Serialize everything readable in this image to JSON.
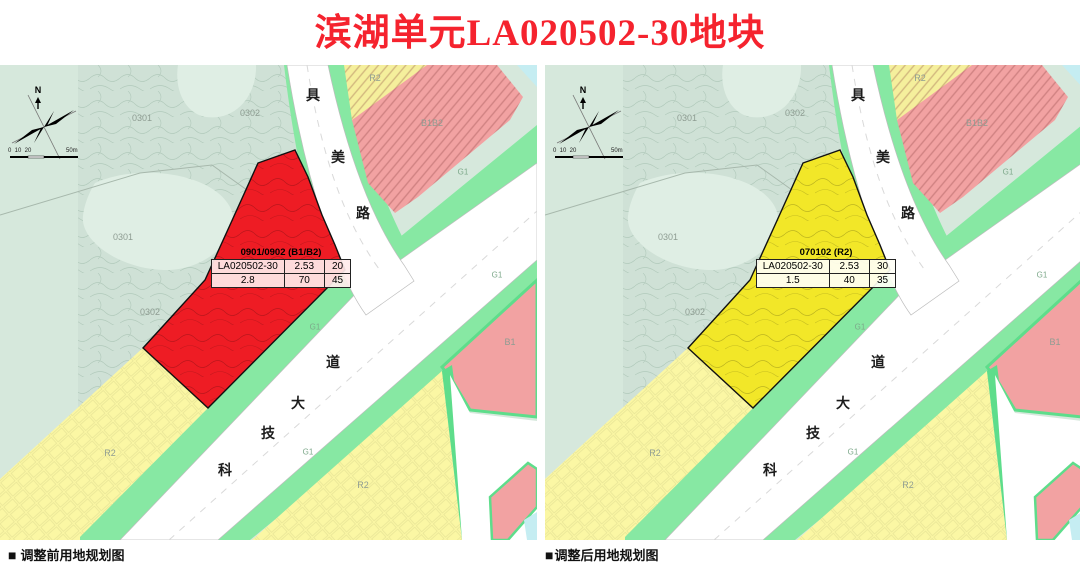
{
  "title": "滨湖单元LA020502-30地块",
  "title_color": "#f5232e",
  "maps": [
    {
      "name": "before",
      "caption_marker": "■",
      "caption": "调整前用地规划图",
      "plot_color": "#ee1c24",
      "plot_table": {
        "header": "0901/0902 (B1/B2)",
        "rows": [
          [
            "LA020502-30",
            "2.53",
            "20"
          ],
          [
            "2.8",
            "70",
            "45"
          ]
        ]
      }
    },
    {
      "name": "after",
      "caption_marker": "■",
      "caption": "调整后用地规划图",
      "plot_color": "#f2e728",
      "plot_table": {
        "header": "070102 (R2)",
        "rows": [
          [
            "LA020502-30",
            "2.53",
            "30"
          ],
          [
            "1.5",
            "40",
            "35"
          ]
        ]
      }
    }
  ],
  "area_labels": [
    {
      "text": "0301",
      "x": 142,
      "y": 53
    },
    {
      "text": "0301",
      "x": 123,
      "y": 172
    },
    {
      "text": "0302",
      "x": 250,
      "y": 48
    },
    {
      "text": "0302",
      "x": 150,
      "y": 247
    },
    {
      "text": "R2",
      "x": 375,
      "y": 13
    },
    {
      "text": "B1B2",
      "x": 432,
      "y": 58
    },
    {
      "text": "G1",
      "x": 463,
      "y": 107,
      "cls": "g1"
    },
    {
      "text": "G1",
      "x": 497,
      "y": 210,
      "cls": "g1"
    },
    {
      "text": "G1",
      "x": 315,
      "y": 262,
      "cls": "g1"
    },
    {
      "text": "G1",
      "x": 308,
      "y": 387,
      "cls": "g1"
    },
    {
      "text": "B1",
      "x": 510,
      "y": 277
    },
    {
      "text": "R2",
      "x": 363,
      "y": 420
    },
    {
      "text": "R2",
      "x": 110,
      "y": 388
    }
  ],
  "road_labels": [
    {
      "text": "具美路",
      "positions": [
        [
          313,
          30
        ],
        [
          338,
          92
        ],
        [
          363,
          148
        ]
      ]
    },
    {
      "text": "科技大道",
      "positions": [
        [
          225,
          405
        ],
        [
          268,
          368
        ],
        [
          298,
          338
        ],
        [
          333,
          297
        ]
      ]
    }
  ],
  "compass": {
    "north": "N",
    "scale_left": "0  10  20",
    "scale_right": "50m"
  },
  "colors": {
    "teal_flat": "#d6e8dc",
    "teal_contour": "#cfe1d6",
    "teal_blob": "#dfeee4",
    "contour_line": "#aec7b8",
    "pale_yellow": "#fbf7a4",
    "r2_top_yellow": "#f5ef9c",
    "pink": "#f2a2a2",
    "green": "#87e8a3",
    "green_deep": "#5edd8b",
    "cyan": "#c5edf2",
    "road_white": "#ffffff",
    "road_edge": "#bdbdbd",
    "plot_outline": "#111111"
  }
}
